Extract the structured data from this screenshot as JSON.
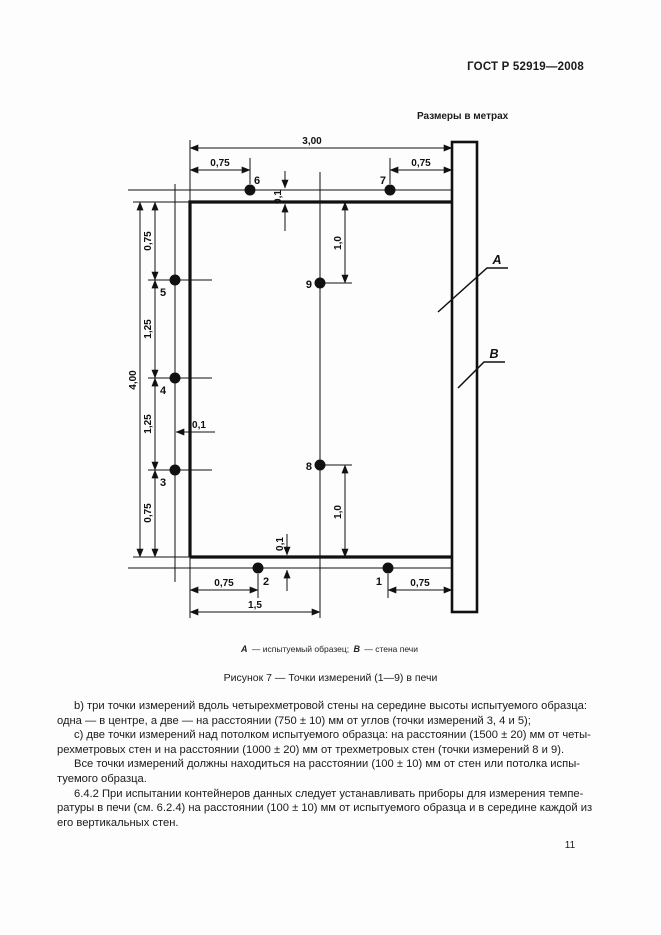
{
  "page": {
    "header": "ГОСТ Р 52919—2008",
    "units_note": "Размеры в метрах",
    "page_number": "11"
  },
  "figure": {
    "points": {
      "p1": "1",
      "p2": "2",
      "p3": "3",
      "p4": "4",
      "p5": "5",
      "p6": "6",
      "p7": "7",
      "p8": "8",
      "p9": "9"
    },
    "dims": {
      "width_top": "3,00",
      "corner_top_left": "0,75",
      "corner_top_right": "0,75",
      "height_left": "4,00",
      "seg_top": "0,75",
      "seg_mid1": "1,25",
      "seg_mid2": "1,25",
      "seg_bottom": "0,75",
      "mid_from_top": "1,0",
      "mid_from_bottom": "1,0",
      "offset_top": "0,1",
      "offset_left": "0,1",
      "offset_bottom": "0,1",
      "corner_bottom_left": "0,75",
      "corner_bottom_right": "0,75",
      "center_from_left": "1,5"
    },
    "wall_labels": {
      "a": "А",
      "b": "В"
    },
    "legend": {
      "a_label": "А",
      "a_text": "— испытуемый образец;",
      "b_label": "В",
      "b_text": "— стена печи"
    },
    "caption": "Рисунок 7 — Точки измерений (1—9) в печи"
  },
  "body": {
    "lines": [
      "b) три точки измерений вдоль четырехметровой стены на середине высоты испытуемого образца:",
      "одна — в центре, а две — на расстоянии (750 ± 10) мм от углов (точки измерений 3, 4 и 5);",
      "c) две точки измерений над потолком испытуемого образца: на расстоянии (1500 ± 20) мм от четы-",
      "рехметровых стен и на расстоянии (1000 ± 20) мм от трехметровых стен (точки измерений 8 и 9).",
      "Все точки измерений должны находиться на расстоянии (100 ± 10) мм от стен или потолка испы-",
      "туемого образца.",
      "6.4.2 При испытании контейнеров данных следует устанавливать приборы для измерения темпе-",
      "ратуры в печи (см. 6.2.4) на расстоянии (100 ± 10) мм от испытуемого образца и в середине каждой из",
      "его вертикальных стен."
    ]
  }
}
